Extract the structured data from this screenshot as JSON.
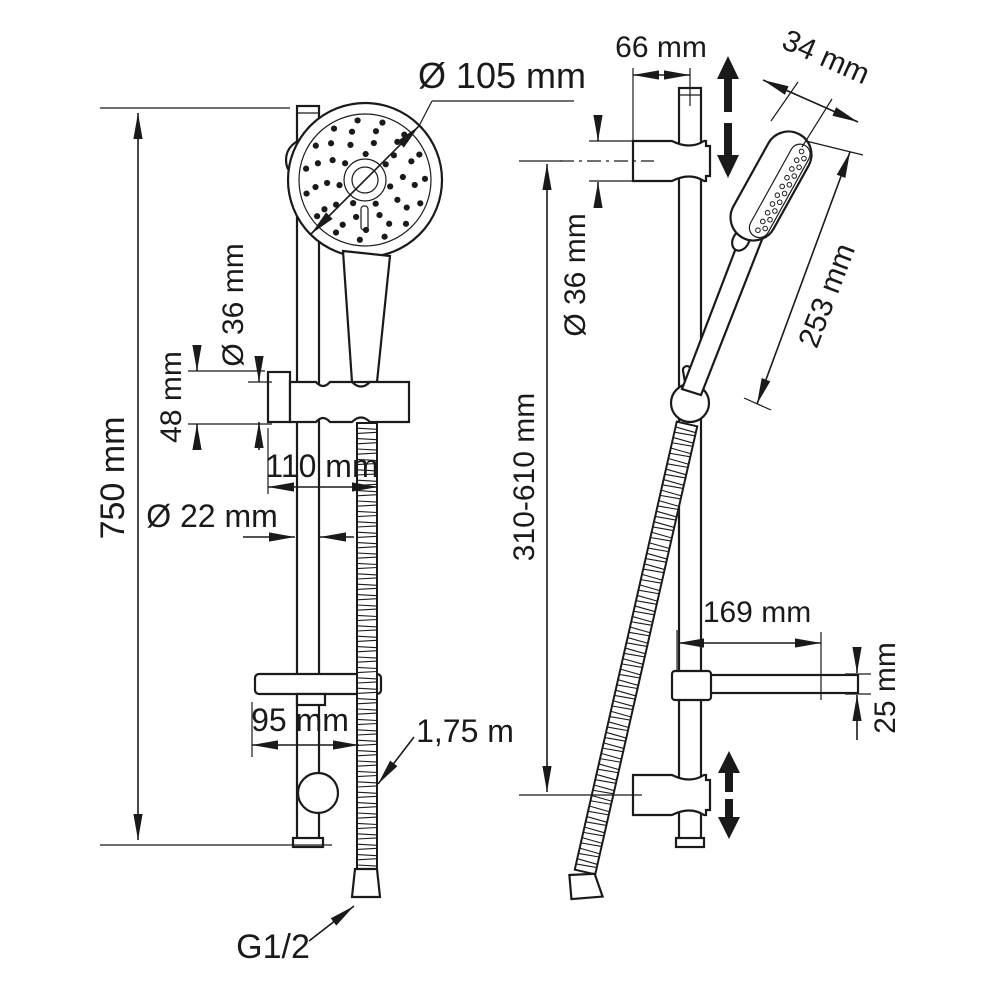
{
  "title": "Shower rail set technical drawing",
  "colors": {
    "line": "#1a1a1a",
    "background": "#ffffff"
  },
  "front_view": {
    "overall_height": "750 mm",
    "head_diameter": "Ø 105 mm",
    "holder_diameter": "Ø 36 mm",
    "holder_height": "48 mm",
    "holder_width": "110 mm",
    "bar_diameter": "Ø 22 mm",
    "soap_dish_width": "95 mm",
    "hose_length": "1,75 m",
    "thread": "G1/2"
  },
  "side_view": {
    "wall_distance": "66 mm",
    "head_thickness": "34 mm",
    "bracket_diameter": "Ø 36 mm",
    "handshower_length": "253 mm",
    "slider_range": "310-610 mm",
    "soap_dish_depth": "169 mm",
    "soap_dish_height": "25 mm"
  }
}
